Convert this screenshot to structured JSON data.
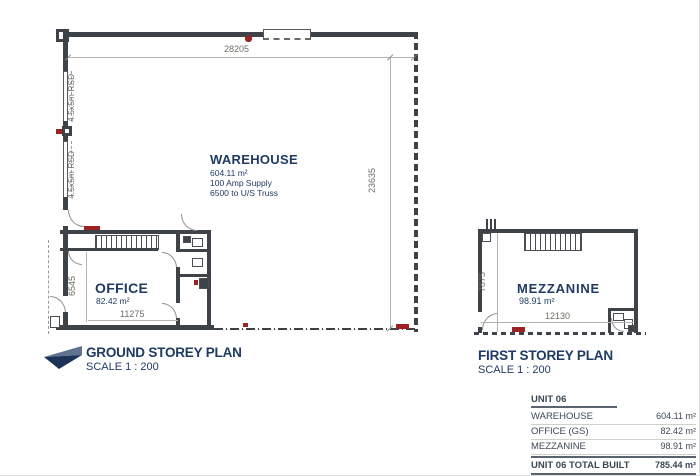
{
  "colors": {
    "navy": "#1f3a63",
    "wall": "#3e4349",
    "red": "#9d2222",
    "dim_text": "#6e6e66"
  },
  "icons": {
    "plan_arrow": "north-arrow-icon"
  },
  "ground_plan": {
    "title": "GROUND STOREY PLAN",
    "scale": "SCALE 1 : 200",
    "warehouse": {
      "name": "WAREHOUSE",
      "area": "604.11 m²",
      "supply": "100 Amp Supply",
      "truss": "6500 to U/S Truss"
    },
    "office": {
      "name": "OFFICE",
      "area": "82.42 m²"
    },
    "dims": {
      "width": "28205",
      "height": "23635",
      "office_width": "11275",
      "office_height": "6545"
    },
    "rsd1": "4.5x5m RSD",
    "rsd2": "4.5x5m RSD"
  },
  "first_plan": {
    "title": "FIRST STOREY PLAN",
    "scale": "SCALE 1 : 200",
    "mezzanine": {
      "name": "MEZZANINE",
      "area": "98.91 m²"
    },
    "dims": {
      "height": "7875",
      "width": "12130"
    }
  },
  "area_table": {
    "header": "UNIT 06",
    "rows": [
      {
        "label": "WAREHOUSE",
        "value": "604.11 m²"
      },
      {
        "label": "OFFICE (GS)",
        "value": "82.42 m²"
      },
      {
        "label": "MEZZANINE",
        "value": "98.91 m²"
      }
    ],
    "total": {
      "label": "UNIT 06 TOTAL BUILT",
      "value": "785.44 m²"
    },
    "yard": {
      "label": "YARD 06",
      "value": "836.07 m²"
    }
  }
}
